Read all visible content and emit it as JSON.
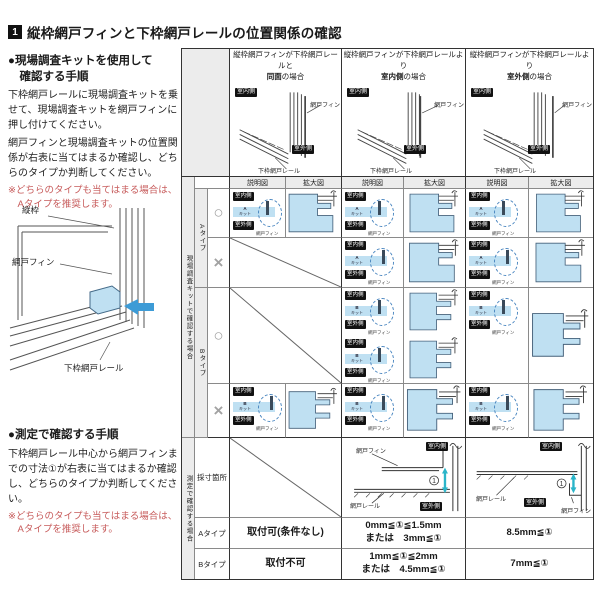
{
  "title": {
    "num": "1",
    "text": "縦枠網戸フィンと下枠網戸レールの位置関係の確認"
  },
  "left_panel": {
    "kit_method": {
      "heading_l1": "●現場調査キットを使用して",
      "heading_l2": "　確認する手順",
      "para1": "下枠網戸レールに現場調査キットを乗せて、現場調査キットを網戸フィンに押し付けてください。",
      "para2": "網戸フィンと現場調査キットの位置関係が右表に当てはまるか確認し、どちらのタイプか判断してください。",
      "note_l1": "※どちらのタイプも当てはまる場合は、",
      "note_l2": "　Aタイプを推奨します。"
    },
    "corner_diagram": {
      "label_frame": "縦枠",
      "label_fin": "網戸フィン",
      "label_rail": "下枠網戸レール"
    },
    "measure_method": {
      "heading": "●測定で確認する手順",
      "para1": "下枠網戸レール中心から網戸フィンまでの寸法①が右表に当てはまるか確認し、どちらのタイプか判断してください。",
      "note_l1": "※どちらのタイプも当てはまる場合は、",
      "note_l2": "　Aタイプを推奨します。"
    }
  },
  "table": {
    "col_headers": [
      {
        "l1": "縦枠網戸フィンが下枠網戸レールと",
        "l2_bold": "同面",
        "l2_rest": "の場合"
      },
      {
        "l1": "縦枠網戸フィンが下枠網戸レールより",
        "l2_bold": "室内側",
        "l2_rest": "の場合"
      },
      {
        "l1": "縦枠網戸フィンが下枠網戸レールより",
        "l2_bold": "室外側",
        "l2_rest": "の場合"
      }
    ],
    "subheaders": {
      "explain": "説明図",
      "enlarge": "拡大図"
    },
    "labels": {
      "indoor": "室内側",
      "outdoor": "室外側",
      "fin": "網戸フィン",
      "bottom_rail": "下枠網戸レール",
      "rail": "網戸レール",
      "kit": "キット",
      "dim": "①"
    },
    "kit_section": {
      "group_label": "現場調査キットで確認する場合",
      "type_a": "Aタイプ",
      "type_b": "Bタイプ",
      "mark_ok": "○",
      "mark_ng": "×",
      "kit_a": "A",
      "kit_b": "B"
    },
    "measure_section": {
      "group_label": "測定で確認する場合",
      "rows": {
        "spot": "採寸箇所",
        "a": "Aタイプ",
        "b": "Bタイプ"
      },
      "a_values": {
        "c1": "取付可(条件なし)",
        "c2_l1": "0mm≦①≦1.5mm",
        "c2_l2": "または　3mm≦①",
        "c3": "8.5mm≦①"
      },
      "b_values": {
        "c1": "取付不可",
        "c2_l1": "1mm≦①≦2mm",
        "c2_l2": "または　4.5mm≦①",
        "c3": "7mm≦①"
      }
    }
  },
  "colors": {
    "kit_blue": "#bfe0f2",
    "cyan_arrow": "#2ab5c9",
    "note_red": "#c75b5b",
    "chip_black": "#111111",
    "strip_gray": "#ececec"
  }
}
